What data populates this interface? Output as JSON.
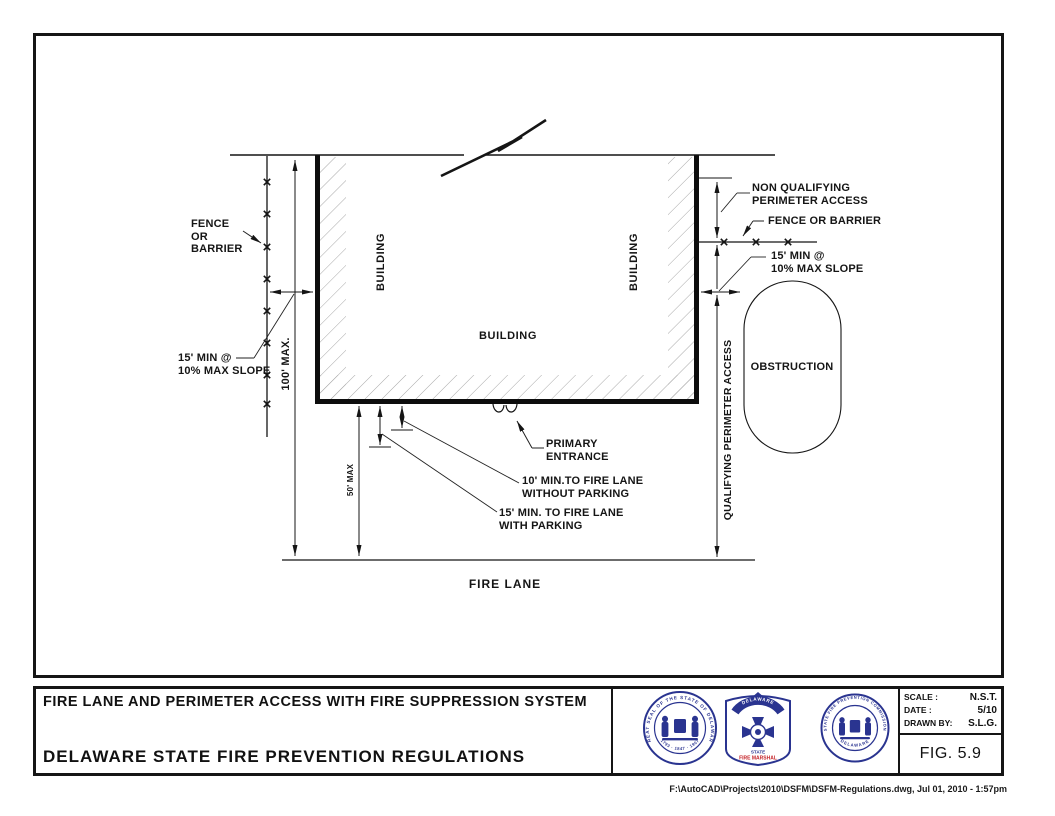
{
  "diagram": {
    "labels": {
      "fence_left": "FENCE\nOR\nBARRIER",
      "slope_left": "15' MIN @\n10% MAX SLOPE",
      "dim_height": "100' MAX.",
      "building_left": "BUILDING",
      "building_center": "BUILDING",
      "building_right": "BUILDING",
      "non_qualifying": "NON QUALIFYING\nPERIMETER ACCESS",
      "fence_right": "FENCE OR BARRIER",
      "slope_right": "15' MIN @\n10% MAX SLOPE",
      "qualifying": "QUALIFYING PERIMETER ACCESS",
      "obstruction": "OBSTRUCTION",
      "primary_entrance": "PRIMARY\nENTRANCE",
      "fire_lane_no_parking": "10' MIN.TO FIRE LANE\nWITHOUT PARKING",
      "fire_lane_with_parking": "15' MIN. TO FIRE LANE\nWITH PARKING",
      "dim_building_to_lane": "50' MAX",
      "fire_lane": "FIRE LANE"
    }
  },
  "title_block": {
    "drawing_title": "FIRE LANE AND PERIMETER ACCESS WITH FIRE SUPPRESSION SYSTEM",
    "organization": "DELAWARE STATE FIRE PREVENTION REGULATIONS",
    "scale_label": "SCALE :",
    "scale_value": "N.S.T.",
    "date_label": "DATE :",
    "date_value": "5/10",
    "drawn_by_label": "DRAWN BY:",
    "drawn_by_value": "S.L.G.",
    "figure": "FIG. 5.9",
    "seals": {
      "great_seal_ring": "GREAT SEAL OF THE STATE OF DELAWARE",
      "great_seal_years": "1793 · 1847 · 1907",
      "marshal_banner": "DELAWARE",
      "marshal_line1": "STATE",
      "marshal_line2": "FIRE MARSHAL",
      "commission_ring_top": "STATE FIRE PREVENTION COMMISSION",
      "commission_ring_bottom": "DELAWARE"
    },
    "colors": {
      "seal_navy": "#2a3490",
      "marshal_red": "#c42127"
    }
  },
  "footer": {
    "file_path": "F:\\AutoCAD\\Projects\\2010\\DSFM\\DSFM-Regulations.dwg, Jul 01, 2010 - 1:57pm"
  }
}
